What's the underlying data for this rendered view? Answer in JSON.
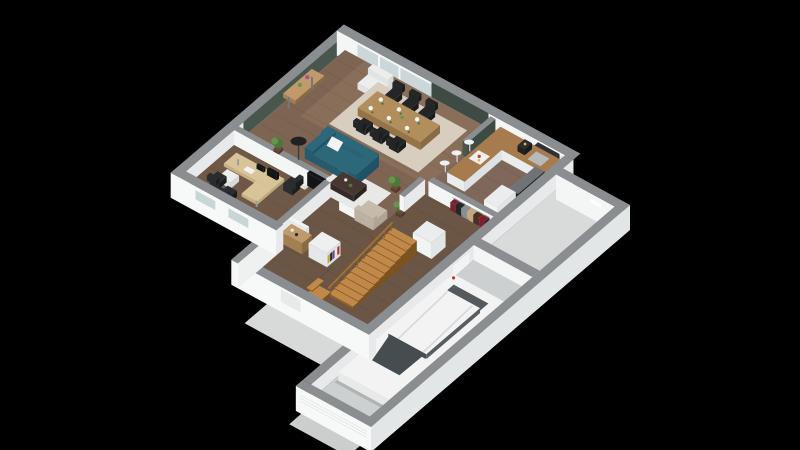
{
  "meta": {
    "type": "3d-floorplan-render",
    "description": "Isometric dollhouse cutaway render of a house ground floor with attached garage on black background",
    "background": "#000000"
  },
  "colors": {
    "bg": "#000000",
    "wall_top": "#8a8e90",
    "wall_white_sw": "#f4f5f5",
    "wall_white_se": "#e7e9ea",
    "wall_exterior": "#f7f8f8",
    "wall_exterior_se": "#e3e6e7",
    "green_wall": "#48564e",
    "green_wall_dark": "#3e4b44",
    "floor_main": "#7e6452",
    "floor_dining": "#947862",
    "floor_office": "#6f5846",
    "floor_hall": "#6b5646",
    "floor_kitchen": "#7f685a",
    "floor_utility": "#d9dbdb",
    "floor_garage": "#cdd0d1",
    "ground_white": "#f0f1f1",
    "rug_dining": "#d8cec0",
    "rug_living": "#e8e9e7",
    "sofa_top": "#2c6879",
    "sofa_sw": "#255b6d",
    "sofa_se": "#1f5264",
    "pillow": "#f2f2f0",
    "table_wood": "#b28e5c",
    "table_wood_side": "#96744a",
    "chair_black": "#232527",
    "coffee_table": "#463733",
    "coffee_table_side": "#352a27",
    "tv_black": "#131415",
    "desk_wood": "#d8c498",
    "desk_wood_sw": "#c9b184",
    "desk_wood_se": "#bfa97e",
    "sideboard": "#c09a6a",
    "sideboard_side": "#a37f52",
    "stair_light": "#c0894a",
    "stair_dark": "#8d5f28",
    "rail_wood": "#a5722f",
    "counter_white": "#eaeced",
    "counter_white_se": "#dfe2e3",
    "counter_top": "#a67c4f",
    "appliance_dark": "#2a2c2e",
    "steel": "#b6babb",
    "stool": "#f0f1f1",
    "car_top": "#f2f3f2",
    "car_se": "#dde0e0",
    "car_front": "#e8eaea",
    "glass_dark": "#464d50",
    "glass_side": "#575e61",
    "tail_red": "#c2392c",
    "wheel": "#313437",
    "plant_green": "#4c7837",
    "plant_green_light": "#65944a",
    "pot_brown": "#6a4a3a",
    "lamp_black": "#1f2123",
    "armchair_white": "#eceeed",
    "armchair_beige": "#c6bbaa",
    "door_white": "#f2f3f3",
    "glass_pane": "#a9bdc0",
    "frame_white": "#f5f6f6",
    "window_band": "#d8e4e5",
    "hood_dark": "#2e3133",
    "flower_pink": "#b05090",
    "coffee_yellow": "#d8b23a",
    "food_red": "#c03a2a",
    "books": [
      "#a93434",
      "#e8e8e8",
      "#6a4a8a",
      "#2a2a2e",
      "#c8a040"
    ],
    "clothes": [
      "#7d1f2c",
      "#222529",
      "#8b8e91",
      "#c4a87c",
      "#4a3123"
    ]
  },
  "rooms": [
    {
      "name": "living-room",
      "floor": "wood",
      "objects": [
        "teal-sofa",
        "white-pillow",
        "coffee-table",
        "white-rug",
        "tv",
        "tv-stand",
        "floor-lamp",
        "potted-plants",
        "beige-armchair"
      ]
    },
    {
      "name": "dining-area",
      "floor": "wood",
      "objects": [
        "wooden-dining-table",
        "black-dining-chairs",
        "place-settings",
        "beige-rug",
        "console-table",
        "white-armchair",
        "flower-vase",
        "sliding-glass-door"
      ]
    },
    {
      "name": "kitchen",
      "floor": "wood",
      "objects": [
        "l-shaped-counter",
        "peninsula",
        "bar-stools",
        "coffee-machine",
        "sink",
        "upper-cabinets",
        "extractor-hood",
        "oven-tower",
        "tall-cabinet",
        "food-tray",
        "green-accent-panel"
      ]
    },
    {
      "name": "office",
      "floor": "wood",
      "objects": [
        "l-shaped-desk",
        "monitor",
        "laptop",
        "desk-chair",
        "guest-chairs",
        "drawer-unit",
        "sideboard",
        "open-door"
      ]
    },
    {
      "name": "hallway",
      "floor": "wood",
      "objects": [
        "wooden-staircase",
        "stair-railing",
        "bookshelf",
        "coat-rack",
        "wall-closet",
        "entry-step"
      ]
    },
    {
      "name": "utility-room",
      "floor": "concrete",
      "objects": [
        "wall-panel"
      ]
    },
    {
      "name": "garage",
      "floor": "concrete",
      "objects": [
        "white-car",
        "garage-door",
        "side-door"
      ]
    }
  ],
  "counts": {
    "dining_chairs": 6,
    "bar_stools": 3,
    "guest_chairs": 2,
    "cars": 1
  }
}
